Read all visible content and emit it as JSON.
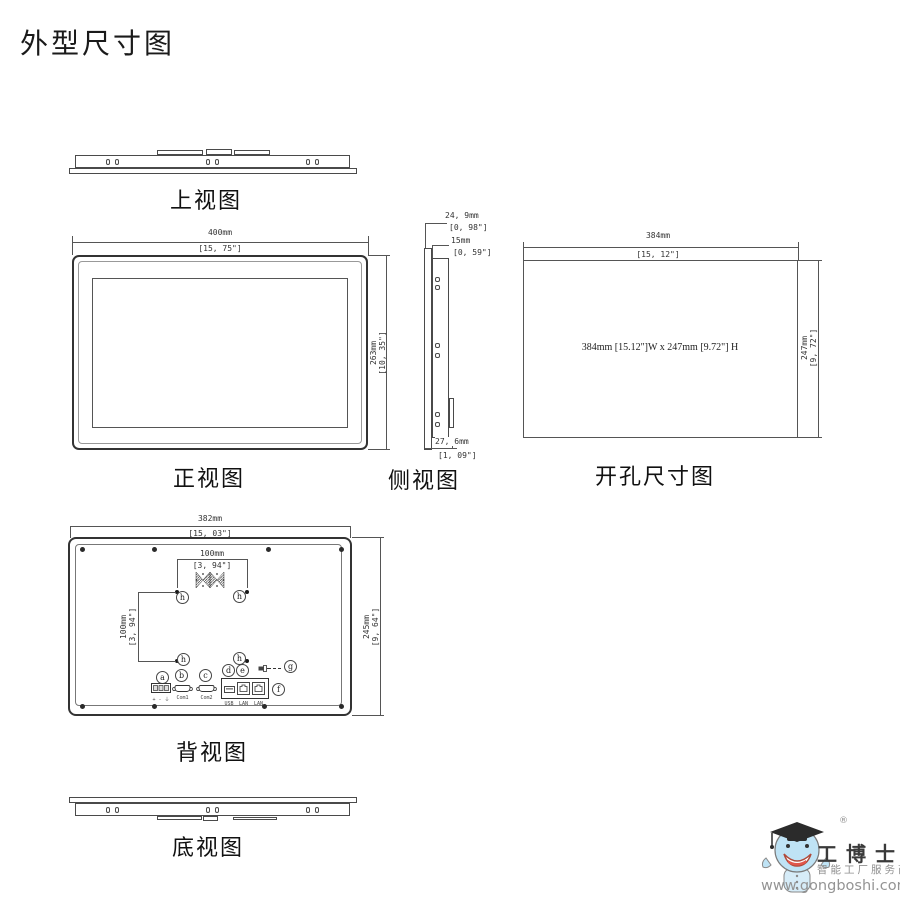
{
  "title": "外型尺寸图",
  "views": {
    "top": {
      "label": "上视图"
    },
    "front": {
      "label": "正视图",
      "width_mm": "400mm",
      "width_in": "[15, 75\"]",
      "height_mm": "263mm",
      "height_in": "[10, 35\"]"
    },
    "side": {
      "label": "侧视图",
      "total_depth_mm": "24, 9mm",
      "total_depth_in": "[0, 98\"]",
      "body_depth_mm": "15mm",
      "body_depth_in": "[0, 59\"]",
      "bottom_depth_mm": "27, 6mm",
      "bottom_depth_in": "[1, 09\"]"
    },
    "cutout": {
      "label": "开孔尺寸图",
      "width_mm": "384mm",
      "width_in": "[15, 12\"]",
      "height_mm": "247mm",
      "height_in": "[9, 72\"]",
      "center_note": "384mm [15.12\"]W x 247mm [9.72\"] H"
    },
    "back": {
      "label": "背视图",
      "width_mm": "382mm",
      "width_in": "[15, 03\"]",
      "height_mm": "245mm",
      "height_in": "[9, 64\"]",
      "vesa_h_mm": "100mm",
      "vesa_h_in": "[3, 94\"]",
      "vesa_v_mm": "100mm",
      "vesa_v_in": "[3, 94\"]",
      "port_labels": {
        "a": "a",
        "b": "b",
        "c": "c",
        "d": "d",
        "e": "e",
        "f": "f",
        "g": "g",
        "h": "h"
      },
      "port_sublabels": {
        "power": "+ - ⏚",
        "com1": "Com1",
        "com2": "Com2",
        "usb": "USB",
        "lan1": "LAN",
        "lan2": "LAN"
      }
    },
    "bottom": {
      "label": "底视图"
    }
  },
  "logo": {
    "registered": "®",
    "brand": "工博士",
    "tagline": "智能工厂服务商",
    "url": "www.gongboshi.com"
  }
}
